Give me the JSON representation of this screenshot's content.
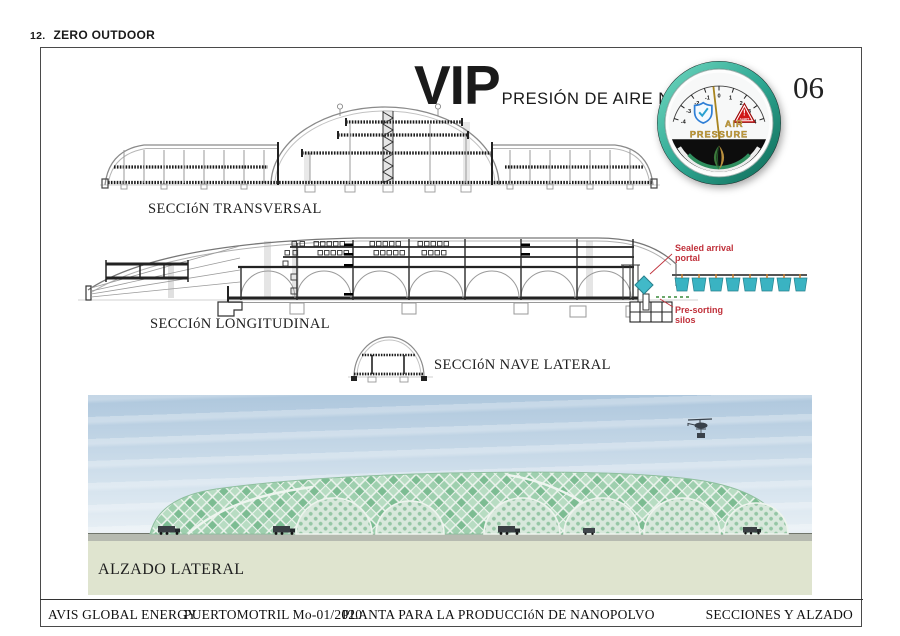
{
  "header": {
    "number": "12.",
    "title": "ZERO OUTDOOR"
  },
  "title": {
    "main": "VIP",
    "subtitle": "PRESIÓN DE AIRE NEGATIVA"
  },
  "page_number": "06",
  "gauge": {
    "label_line1": "AIR",
    "label_line2": "PRESSURE",
    "alert_mark": "!",
    "alert_text": "ALERT",
    "scale": [
      "-4",
      "-3",
      "-2",
      "-1",
      "0",
      "1",
      "2",
      "3",
      "4"
    ],
    "colors": {
      "ring_teal": "#2fa893",
      "gold": "#c9a23e",
      "alert_red": "#d01818",
      "shield_blue": "#2f7fd6"
    }
  },
  "sections": {
    "transversal_label": "SECCIóN TRANSVERSAL",
    "longitudinal_label": "SECCIóN LONGITUDINAL",
    "nave_lateral_label": "SECCIóN NAVE LATERAL",
    "alzado_label": "ALZADO LATERAL"
  },
  "annotations": {
    "sealed_line1": "Sealed arrival",
    "sealed_line2": "portal",
    "presort_line1": "Pre-sorting",
    "presort_line2": "silos",
    "color": "#c0313b"
  },
  "footer": {
    "company": "AVIS GLOBAL ENERGY",
    "code": "PUERTOMOTRIL  Mo-01/2020",
    "project": "PLANTA PARA LA PRODUCCIóN DE NANOPOLVO",
    "sheet_title": "SECCIONES Y ALZADO"
  },
  "render_colors": {
    "sky": "#b7cee1",
    "ground": "#dfe4cf",
    "dome_green": "#8cc3a0",
    "portal_teal": "#3ab3c2",
    "conveyor_hook_orange": "#c97f2f"
  }
}
